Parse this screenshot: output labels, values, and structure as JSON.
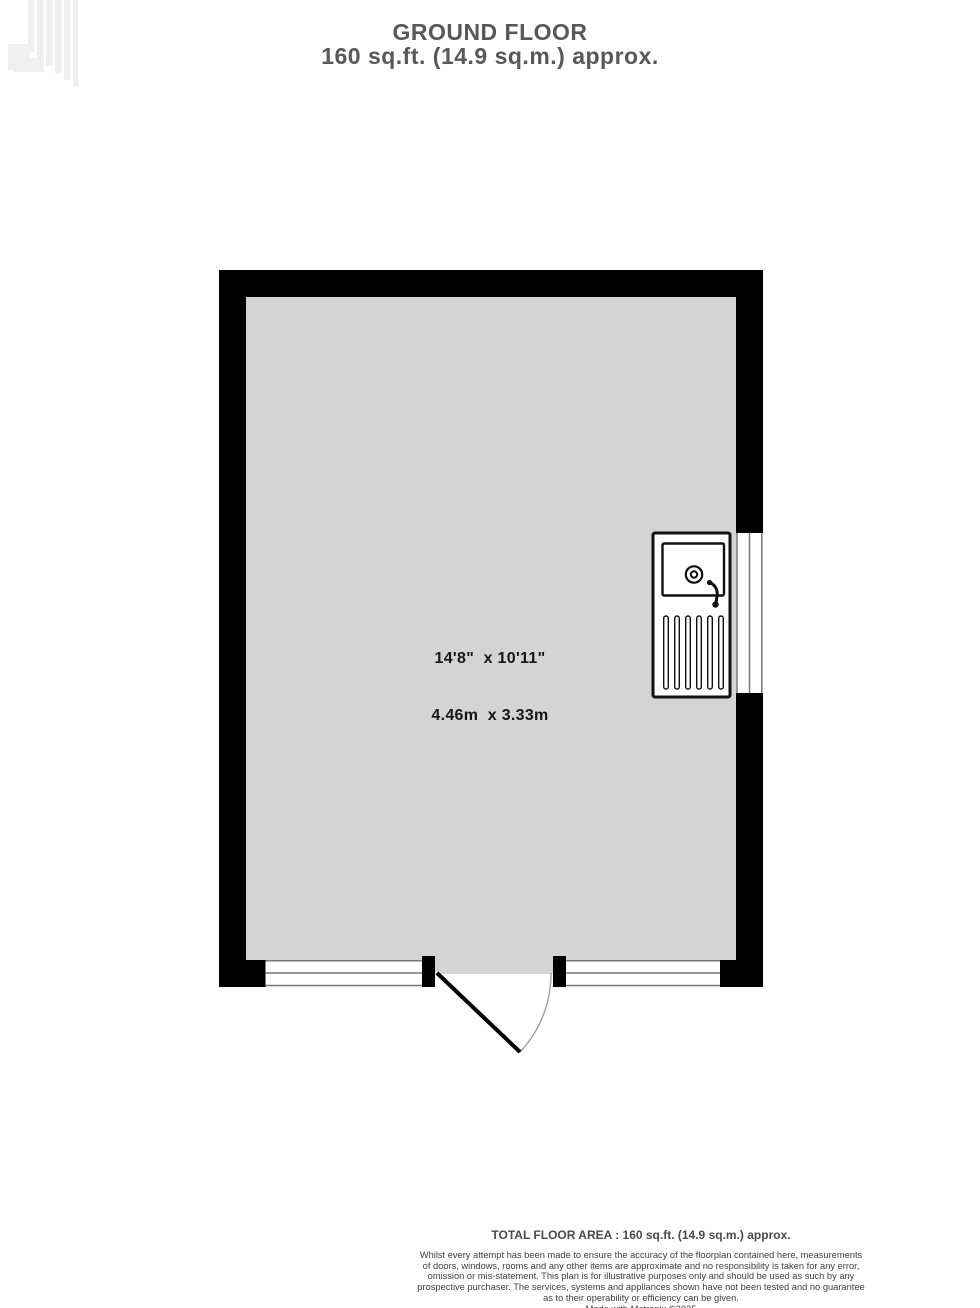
{
  "header": {
    "title": "GROUND FLOOR",
    "subtitle": "160 sq.ft. (14.9 sq.m.) approx."
  },
  "floorplan": {
    "floor_name": "Ground Floor",
    "room": {
      "dimensions_imperial": "14'8\"  x 10'11\"",
      "dimensions_metric": "4.46m  x 3.33m"
    },
    "fixtures": [
      {
        "name": "sink-unit-with-drainer",
        "wall": "right"
      }
    ],
    "features": [
      {
        "name": "window",
        "wall": "bottom-left"
      },
      {
        "name": "door",
        "wall": "bottom-center",
        "swing": "outward"
      },
      {
        "name": "window",
        "wall": "bottom-right"
      },
      {
        "name": "window",
        "wall": "right"
      }
    ],
    "colors": {
      "wall": "#000000",
      "floor": "#d4d4d4",
      "window_frame": "#777777",
      "door_leaf": "#000000",
      "door_arc": "#999999",
      "fixture_outline": "#111111"
    }
  },
  "footer": {
    "total_area": "TOTAL FLOOR AREA : 160 sq.ft. (14.9 sq.m.) approx.",
    "disclaimer_lines": [
      "Whilst every attempt has been made to ensure the accuracy of the floorplan contained here, measurements",
      "of doors, windows, rooms and any other items are approximate and no responsibility is taken for any error,",
      "omission or mis-statement. This plan is for illustrative purposes only and should be used as such by any",
      "prospective purchaser. The services, systems and appliances shown have not been tested and no guarantee",
      "as to their operability or efficiency can be given."
    ],
    "credit": "Made with Metropix ©2025"
  }
}
